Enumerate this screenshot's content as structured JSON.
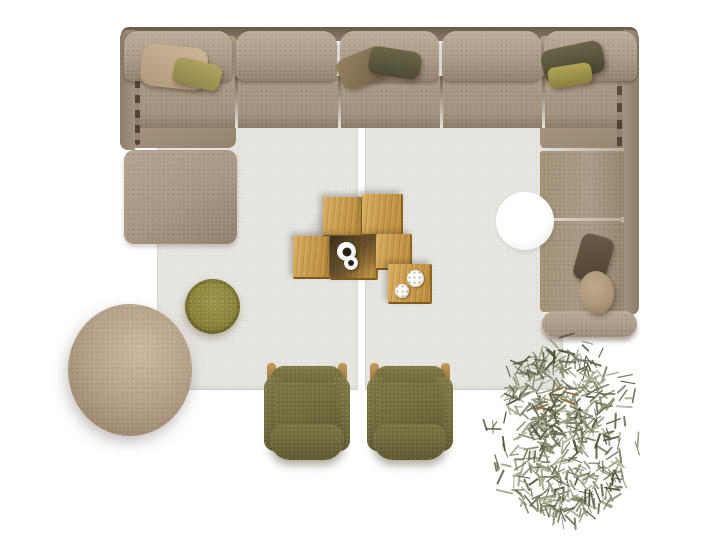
{
  "scene": {
    "description": "Top-down 3D render of a living room furniture arrangement on a white floor",
    "background": "#ffffff"
  },
  "palette": {
    "floor": "#ffffff",
    "rug": "#e9e7e2",
    "sofa_fabric": "#a79682",
    "sofa_fabric_light": "#bdad9b",
    "sofa_fabric_dark": "#8d7b68",
    "oak_wood": "#c89a4b",
    "oak_wood_dark": "#8a6526",
    "olive_chair": "#6c6738",
    "olive_pouf": "#8a8439",
    "beige_pouf": "#b6a189",
    "table_white": "#ffffff",
    "pillow_beige": "#c3ad8f",
    "pillow_olive": "#a29655",
    "pillow_brown": "#86715a",
    "pillow_dark_olive": "#55523a",
    "pillow_tan": "#ab9478",
    "plant_leaf_colors": [
      "#4c5138",
      "#5f6449",
      "#757a5c",
      "#8b9070",
      "#a3a88c"
    ],
    "twig_brown": "#8a6a35"
  },
  "items": {
    "rug": {
      "label": "Two-panel light grey area rug with centre seam"
    },
    "sofa": {
      "label": "U-shaped sectional sofa in taupe fabric, five back cushions, six throw pillows"
    },
    "chaise": {
      "label": "Armless chaise seat module of the sectional"
    },
    "side_table": {
      "label": "Round white side table"
    },
    "coffee_tables": {
      "label": "Cluster of six oak cube coffee tables"
    },
    "cups": {
      "label": "Two white espresso cups on the cube table"
    },
    "flowers": {
      "label": "Two white flower dishes on the cube table"
    },
    "pouf_large": {
      "label": "Large round beige pouf"
    },
    "pouf_small": {
      "label": "Small round olive pouf"
    },
    "armchair_left": {
      "label": "Olive green lounge armchair, top view"
    },
    "armchair_right": {
      "label": "Olive green lounge armchair, top view"
    },
    "plant": {
      "label": "Olive plant foliage seen from above"
    }
  }
}
